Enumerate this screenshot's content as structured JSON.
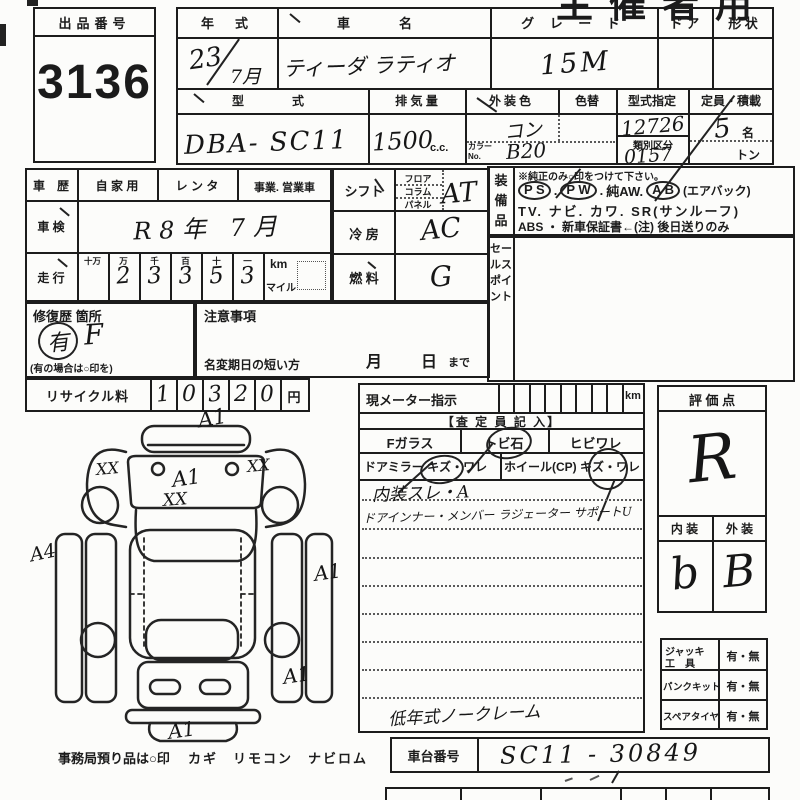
{
  "meta": {
    "organizer_title": "主催者用"
  },
  "exhibit": {
    "label": "出品番号",
    "number": "3136"
  },
  "vehicle": {
    "year_label": "年　式",
    "year": "23",
    "month": "7月",
    "name_label": "車　名",
    "name": "ティーダ ラティオ",
    "grade_label": "グ レ ー ド",
    "grade": "15M",
    "door_label": "ド ア",
    "shape_label": "形 状",
    "model_label": "型　　式",
    "model": "DBA- SC11",
    "disp_label": "排 気 量",
    "disp": "1500",
    "disp_unit": "c.c.",
    "color_label": "外装色",
    "color": "コン",
    "color_change_label": "色替",
    "color_no_label": "カラーNo.",
    "color_no": "B20",
    "type_no_label": "型式指定",
    "type_no": "12726",
    "class_label": "類別区分",
    "class_no": "0157",
    "capacity_label": "定員・積載",
    "capacity": "5",
    "capacity_unit": "名",
    "load_unit": "トン"
  },
  "history": {
    "label": "車　歴",
    "owner_private": "自 家 用",
    "owner_rental": "レ ン タ",
    "owner_business": "事業. 営業車",
    "shaken_label": "車 検",
    "shaken": "R 8 年　7 月",
    "mileage_label": "走 行",
    "digit_headers": [
      "十万",
      "万",
      "千",
      "百",
      "十",
      "一"
    ],
    "digits": [
      "",
      "2",
      "3",
      "3",
      "5",
      "3"
    ],
    "km": "km",
    "mile": "マイル"
  },
  "controls": {
    "shift_label": "シフト",
    "floor": "フロア",
    "column": "コラム",
    "panel": "パネル",
    "shift": "AT",
    "ac_label": "冷 房",
    "ac": "AC",
    "fuel_label": "燃 料",
    "fuel": "G"
  },
  "equipment": {
    "label": "装備品",
    "note": "※純正のみ○印をつけて下さい。",
    "ps": "P S",
    "pw": "P W",
    "aw": "純AW.",
    "ab": "A B",
    "ab_note": "(エアバック)",
    "line2": "TV. ナビ. カワ. SR(サンルーフ)",
    "line3": "ABS ・ 新車保証書←(注) 後日送りのみ"
  },
  "sales_point": {
    "label": "セールスポイント"
  },
  "repair": {
    "label": "修復歴 箇所",
    "mark": "有",
    "letter": "F",
    "note": "(有の場合は○印を)"
  },
  "caution": {
    "label": "注意事項",
    "name_change": "名変期日の短い方",
    "month": "月",
    "day": "日",
    "until": "まで"
  },
  "recycle": {
    "label": "リサイクル料",
    "digits": [
      "1",
      "0",
      "3",
      "2",
      "0"
    ],
    "yen": "円"
  },
  "diagram": {
    "mark_front": "A1",
    "mark_mirror_l": "XX",
    "mark_mirror_r": "XX",
    "mark_ws1": "A1",
    "mark_ws2": "XX",
    "mark_side_l": "A4",
    "mark_side_r": "A1",
    "mark_rear_r": "A1",
    "mark_rear_b": "A1",
    "storage_note": "事務局預り品は○印",
    "storage_items": "カギ　リモコン　ナビロム"
  },
  "meter": {
    "label": "現メーター指示",
    "unit": "km",
    "assessor": "【査 定 員 記 入】",
    "f_glass": "Fガラス",
    "stone": "トビ石",
    "crack": "ヒビワレ",
    "mirror": "ドアミラー",
    "scratch1": "キズ・ワレ",
    "wheel": "ホイール(CP)",
    "scratch2": "キズ・ワレ",
    "note1": "内装スレ・A",
    "note2": "ドアインナー・メンバー ラジェーター サポートU",
    "note3": "低年式ノークレーム"
  },
  "evaluation": {
    "label": "評 価 点",
    "grade": "R",
    "int_label": "内 装",
    "ext_label": "外 装",
    "interior": "b",
    "exterior": "B"
  },
  "tools": {
    "jack1": "ジャッキ",
    "jack2": "工　具",
    "jack_v": "有・無",
    "puncture": "パンクキット",
    "puncture_v": "有・無",
    "spare": "スペアタイヤ",
    "spare_v": "有・無"
  },
  "chassis": {
    "label": "車台番号",
    "vin": "SC11 - 30849"
  }
}
